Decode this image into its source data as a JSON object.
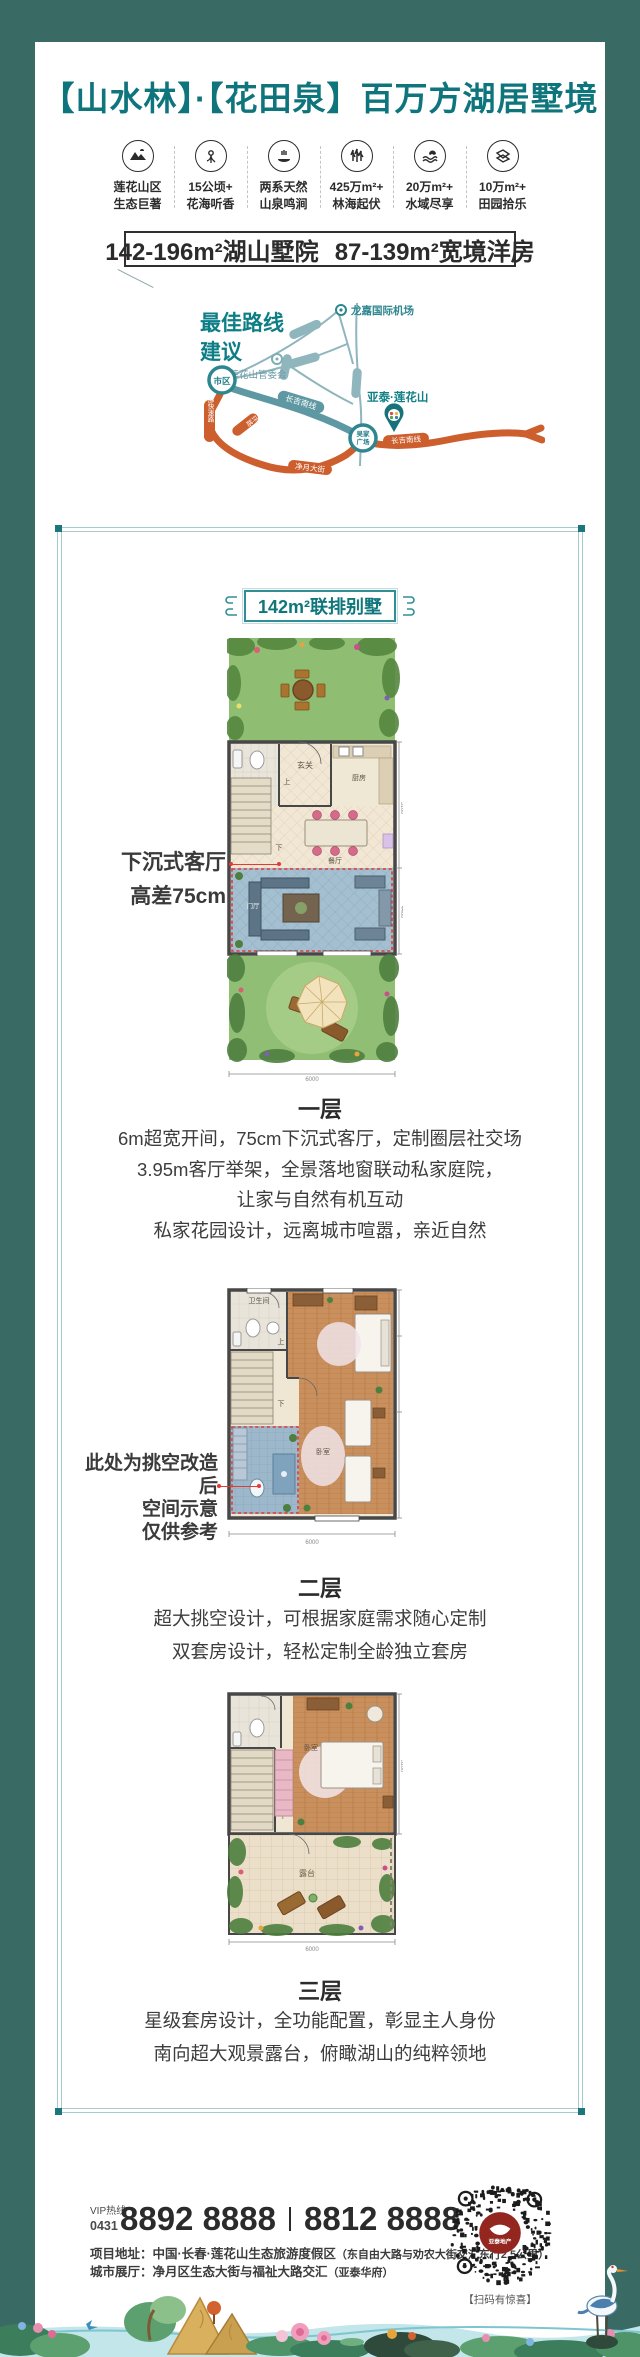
{
  "header": {
    "title": "【山水林】·【花田泉】百万方湖居墅境"
  },
  "features": [
    {
      "icon": "mountain-icon",
      "line1": "莲花山区",
      "line2": "生态巨著"
    },
    {
      "icon": "flower-icon",
      "line1": "15公顷+",
      "line2": "花海听香"
    },
    {
      "icon": "spring-icon",
      "line1": "两系天然",
      "line2": "山泉鸣涧"
    },
    {
      "icon": "forest-icon",
      "line1": "425万m²+",
      "line2": "林海起伏"
    },
    {
      "icon": "water-icon",
      "line1": "20万m²+",
      "line2": "水域尽享"
    },
    {
      "icon": "field-icon",
      "line1": "10万m²+",
      "line2": "田园拾乐"
    }
  ],
  "banner": {
    "left": "142-196m²湖山墅院",
    "right": "87-139m²宽境洋房"
  },
  "map": {
    "title_line1": "最佳路线",
    "title_line2": "建议",
    "airport": "龙嘉国际机场",
    "committee": "莲花山管委会",
    "downtown": "市区",
    "plaza_line1": "吴家",
    "plaza_line2": "广场",
    "project": "亚泰·莲花山",
    "road_changji_1": "长吉南线",
    "road_changji_2": "长吉南线",
    "road_east_express": "东部快速路",
    "road_ring": "二环路",
    "road_jingyue": "净月大街"
  },
  "panel": {
    "title": "142m²联排别墅"
  },
  "floor1": {
    "callout_line1": "下沉式客厅",
    "callout_line2": "高差75cm",
    "heading": "一层",
    "lines": [
      "6m超宽开间，75cm下沉式客厅，定制圈层社交场",
      "3.95m客厅举架，全景落地窗联动私家庭院，",
      "让家与自然有机互动",
      "私家花园设计，远离城市喧嚣，亲近自然"
    ],
    "rooms": {
      "bath": "卫生间",
      "foyer": "玄关",
      "kitchen": "厨房",
      "up": "上",
      "down": "下",
      "dining": "餐厅",
      "hall": "门厅"
    },
    "dims": {
      "right_top": "5100",
      "right_bottom": "4400",
      "width": "6000"
    }
  },
  "floor2": {
    "callout_line1": "此处为挑空改造后",
    "callout_line2": "空间示意",
    "callout_line3": "仅供参考",
    "heading": "二层",
    "lines": [
      "超大挑空设计，可根据家庭需求随心定制",
      "双套房设计，轻松定制全龄独立套房"
    ],
    "rooms": {
      "bath": "卫生间",
      "up": "上",
      "down": "下",
      "bedroom": "卧室"
    },
    "dims": {
      "width": "6000"
    }
  },
  "floor3": {
    "heading": "三层",
    "lines": [
      "星级套房设计，全功能配置，彰显主人身份",
      "南向超大观景露台，俯瞰湖山的纯粹领地"
    ],
    "rooms": {
      "bedroom": "卧室",
      "terrace": "露台",
      "down": "下"
    },
    "dims": {
      "right": "5100",
      "width": "6000"
    }
  },
  "footer": {
    "hotline_label": "VIP热线",
    "hotline_code": "0431",
    "phone1": "8892 8888",
    "phone2": "8812 8888",
    "address_label": "项目地址：",
    "address": "中国·长春·莲花山生态旅游度假区",
    "address_note": "（东自由大路与劝农大街交汇东行2.5公里）",
    "hall_label": "城市展厅：",
    "hall": "净月区生态大街与福祉大路交汇",
    "hall_note": "（亚泰华府）",
    "qr_logo": "亚泰地产",
    "qr_caption": "【扫码有惊喜】"
  }
}
